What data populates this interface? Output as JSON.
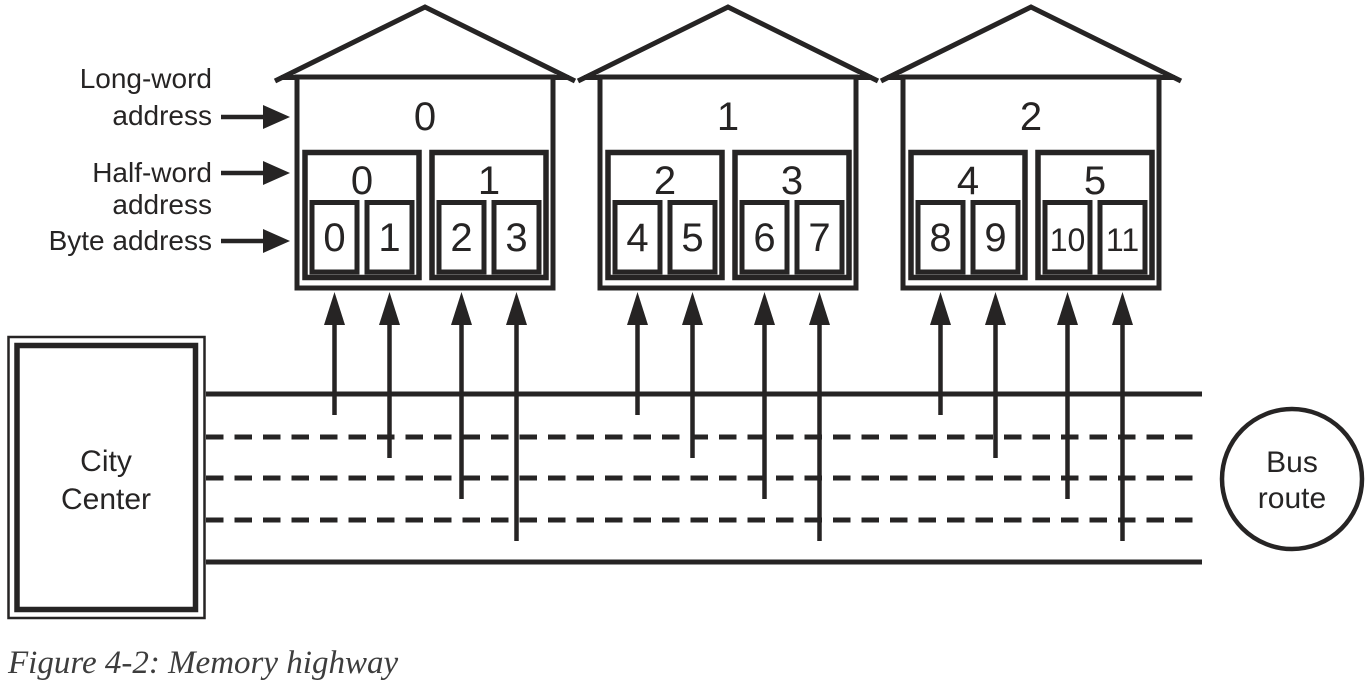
{
  "figure": {
    "caption": "Figure 4-2: Memory highway",
    "background": "#ffffff",
    "ink_color": "#262424",
    "caption_color": "#3d3d3d"
  },
  "address_labels": {
    "long_word_line1": "Long-word",
    "long_word_line2": "address",
    "half_word_line1": "Half-word",
    "half_word_line2": "address",
    "byte_line1": "Byte address"
  },
  "city_center": {
    "label_line1": "City",
    "label_line2": "Center"
  },
  "bus_route": {
    "label_line1": "Bus",
    "label_line2": "route"
  },
  "highway": {
    "lane_styles": [
      "solid",
      "dashed",
      "dashed",
      "dashed",
      "solid"
    ]
  },
  "houses": [
    {
      "long_word_address": "0",
      "half_words": [
        {
          "address": "0",
          "bytes": [
            "0",
            "1"
          ]
        },
        {
          "address": "1",
          "bytes": [
            "2",
            "3"
          ]
        }
      ]
    },
    {
      "long_word_address": "1",
      "half_words": [
        {
          "address": "2",
          "bytes": [
            "4",
            "5"
          ]
        },
        {
          "address": "3",
          "bytes": [
            "6",
            "7"
          ]
        }
      ]
    },
    {
      "long_word_address": "2",
      "half_words": [
        {
          "address": "4",
          "bytes": [
            "8",
            "9"
          ]
        },
        {
          "address": "5",
          "bytes": [
            "10",
            "11"
          ]
        }
      ]
    }
  ]
}
